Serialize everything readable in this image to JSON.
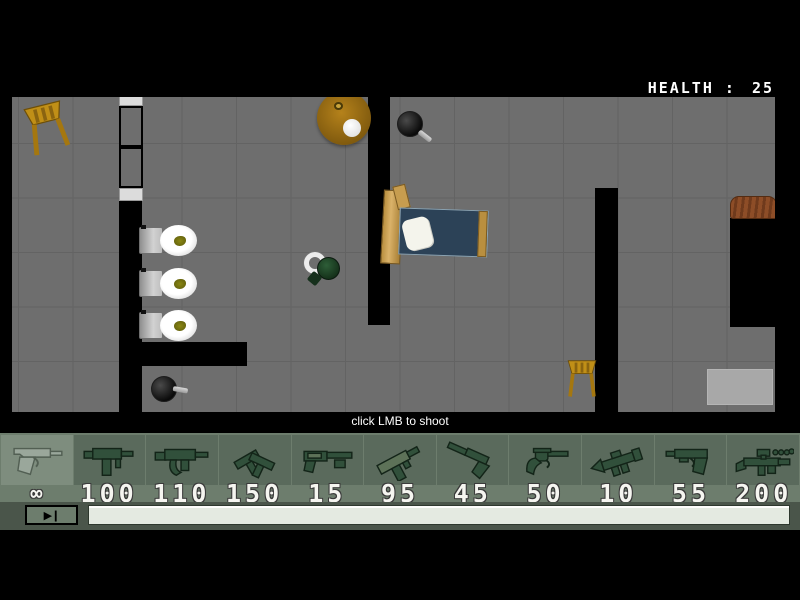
{
  "hud": {
    "health_label": "HEALTH :",
    "health_value": "25"
  },
  "hint": "click LMB to shoot",
  "weapon_bar": {
    "selected_index": 0,
    "slots": [
      {
        "name": "pistol",
        "icon": "pistol-icon",
        "ammo": "∞",
        "selected": true
      },
      {
        "name": "uzi",
        "icon": "uzi-icon",
        "ammo": "100",
        "selected": false
      },
      {
        "name": "mp5",
        "icon": "mp5-icon",
        "ammo": "110",
        "selected": false
      },
      {
        "name": "dual-uzis",
        "icon": "dual-uzis-icon",
        "ammo": "150",
        "selected": false
      },
      {
        "name": "shotgun",
        "icon": "shotgun-icon",
        "ammo": "15",
        "selected": false
      },
      {
        "name": "tec9",
        "icon": "tec9-icon",
        "ammo": "95",
        "selected": false
      },
      {
        "name": "silenced-pistol",
        "icon": "silenced-pistol-icon",
        "ammo": "45",
        "selected": false
      },
      {
        "name": "revolver",
        "icon": "revolver-icon",
        "ammo": "50",
        "selected": false
      },
      {
        "name": "rocket-launcher",
        "icon": "rocket-launcher-icon",
        "ammo": "10",
        "selected": false
      },
      {
        "name": "usp",
        "icon": "usp-icon",
        "ammo": "55",
        "selected": false
      },
      {
        "name": "scoped-rifle",
        "icon": "scoped-rifle-icon",
        "ammo": "200",
        "selected": false
      }
    ]
  },
  "transport": {
    "button_glyph": "▶❙"
  },
  "colors": {
    "floor": "#6e6e6e",
    "grid": "#636363",
    "wall": "#000000",
    "bar_bg": "#6d7d6d",
    "slot_bg": "#5a6a5c",
    "slot_sel_bg": "#7e8d7e",
    "strip_bg": "#4a554a",
    "bed_blue": "#2c4257",
    "health_text": "#ffffff",
    "hint_text": "#ffffff",
    "ammo_text": "#f5f5f0"
  }
}
